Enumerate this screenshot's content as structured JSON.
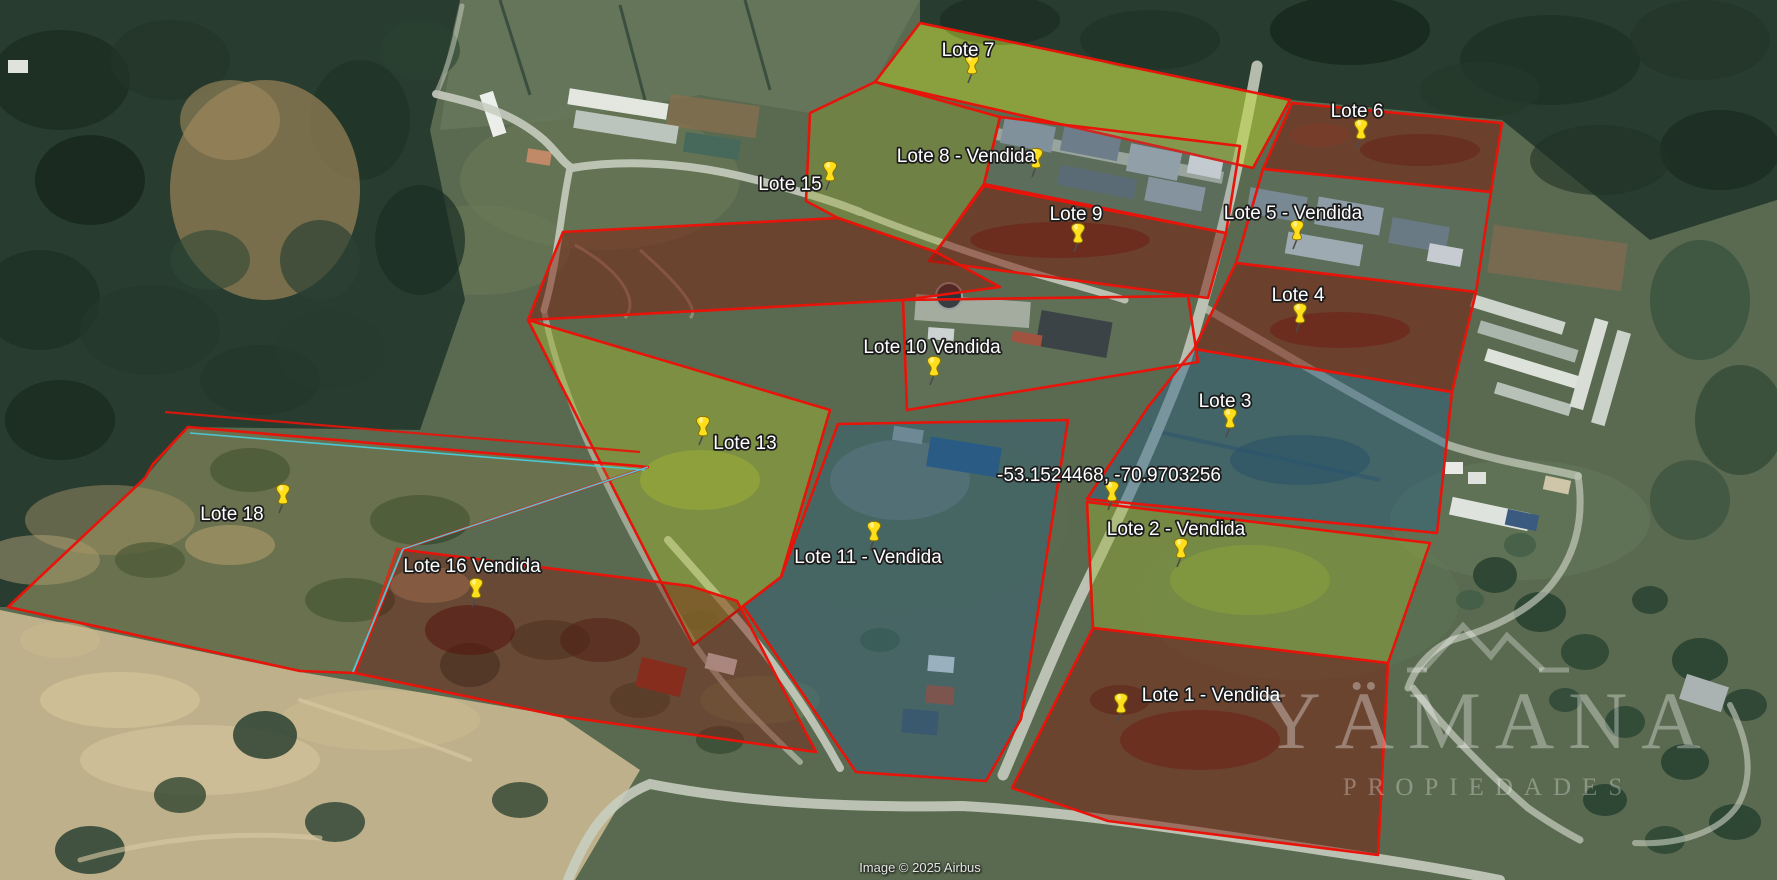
{
  "map": {
    "attribution": "Image © 2025 Airbus",
    "watermark": {
      "brand": "YÄMANA",
      "tagline": "PROPIEDADES"
    },
    "colors": {
      "boundary": "#e81309",
      "boundary_alt": "#49cfe0",
      "pin": "#ffdf1c",
      "pin_stroke": "#8a7500",
      "label": "#ffffff"
    },
    "coordinate_marker": {
      "label": "-53.1524468, -70.9703256",
      "label_x": 1109,
      "label_y": 481,
      "pin_x": 1112,
      "pin_y": 494
    },
    "lots": [
      {
        "id": "lote7",
        "label": "Lote 7",
        "status": "disponible",
        "label_x": 968,
        "label_y": 56,
        "pin_x": 972,
        "pin_y": 67,
        "fill": "#b9d32c",
        "fill_opacity": 0.5,
        "points": "920,23 1290,100 1253,168 875,82"
      },
      {
        "id": "lote15",
        "label": "Lote 15",
        "status": "disponible",
        "label_x": 790,
        "label_y": 190,
        "pin_x": 830,
        "pin_y": 174,
        "fill": "#97a834",
        "fill_opacity": 0.38,
        "points": "810,113 875,82 1000,117 984,184 936,252 838,218 806,201"
      },
      {
        "id": "lote8",
        "label": "Lote 8 - Vendida",
        "status": "vendida",
        "label_x": 966,
        "label_y": 162,
        "pin_x": 1036,
        "pin_y": 161,
        "fill": "#6b8093",
        "fill_opacity": 0.18,
        "points": "1000,117 1240,146 1226,233 984,184"
      },
      {
        "id": "lote9",
        "label": "Lote 9",
        "status": "disponible",
        "label_x": 1076,
        "label_y": 220,
        "pin_x": 1078,
        "pin_y": 236,
        "fill": "#7b1d10",
        "fill_opacity": 0.52,
        "points": "984,186 1226,233 1208,298 929,261"
      },
      {
        "id": "lote6",
        "label": "Lote 6",
        "status": "disponible",
        "label_x": 1357,
        "label_y": 117,
        "pin_x": 1361,
        "pin_y": 132,
        "fill": "#7b1d10",
        "fill_opacity": 0.52,
        "points": "1292,103 1502,123 1491,192 1263,169"
      },
      {
        "id": "lote5",
        "label": "Lote 5 - Vendida",
        "status": "vendida",
        "label_x": 1293,
        "label_y": 219,
        "pin_x": 1297,
        "pin_y": 233,
        "fill": "#6b8093",
        "fill_opacity": 0.15,
        "points": "1263,169 1491,192 1476,292 1236,263"
      },
      {
        "id": "lote4",
        "label": "Lote 4",
        "status": "disponible",
        "label_x": 1298,
        "label_y": 301,
        "pin_x": 1300,
        "pin_y": 316,
        "fill": "#7b1d10",
        "fill_opacity": 0.52,
        "points": "1236,263 1476,292 1452,392 1194,349"
      },
      {
        "id": "lote3",
        "label": "Lote 3",
        "status": "disponible",
        "label_x": 1225,
        "label_y": 407,
        "pin_x": 1230,
        "pin_y": 421,
        "fill": "#275f86",
        "fill_opacity": 0.45,
        "points": "1194,349 1452,392 1437,533 1087,499 1148,407"
      },
      {
        "id": "lote10",
        "label": "Lote 10 Vendida",
        "status": "vendida",
        "label_x": 932,
        "label_y": 353,
        "pin_x": 934,
        "pin_y": 369,
        "fill": "#9aa5a0",
        "fill_opacity": 0.1,
        "points": "903,300 1188,296 1198,362 907,410"
      },
      {
        "id": "lote13",
        "label": "Lote 13",
        "status": "disponible",
        "label_x": 745,
        "label_y": 449,
        "pin_x": 703,
        "pin_y": 429,
        "fill": "#a9bd34",
        "fill_opacity": 0.45,
        "points": "528,320 830,410 781,577 693,645"
      },
      {
        "id": "lote11",
        "label": "Lote 11 - Vendida",
        "status": "vendida",
        "label_x": 868,
        "label_y": 563,
        "pin_x": 874,
        "pin_y": 534,
        "fill": "#275f86",
        "fill_opacity": 0.38,
        "points": "838,424 1068,420 1021,719 986,781 856,772 743,606 781,577"
      },
      {
        "id": "lote2",
        "label": "Lote 2 - Vendida",
        "status": "vendida",
        "label_x": 1176,
        "label_y": 535,
        "pin_x": 1181,
        "pin_y": 551,
        "fill": "#9cb335",
        "fill_opacity": 0.42,
        "points": "1087,502 1430,543 1388,663 1093,628"
      },
      {
        "id": "lote1",
        "label": "Lote 1 - Vendida",
        "status": "vendida",
        "label_x": 1211,
        "label_y": 701,
        "pin_x": 1121,
        "pin_y": 706,
        "fill": "#7b1d10",
        "fill_opacity": 0.5,
        "points": "1093,628 1388,663 1378,855 1108,821 1012,788"
      },
      {
        "id": "lote16",
        "label": "Lote 16 Vendida",
        "status": "vendida",
        "label_x": 472,
        "label_y": 572,
        "pin_x": 476,
        "pin_y": 591,
        "fill": "#7b1d10",
        "fill_opacity": 0.42,
        "points": "397,549 690,586 737,601 816,752 560,716 355,673"
      },
      {
        "id": "lote18",
        "label": "Lote 18",
        "status": "disponible",
        "label_x": 232,
        "label_y": 520,
        "pin_x": 283,
        "pin_y": 497,
        "fill": "#9f8f4d",
        "fill_opacity": 0.22,
        "points": "188,427 648,467 403,549 355,673 300,671 8,607 145,478 153,464"
      },
      {
        "id": "unlabeled-lot",
        "label": "",
        "status": "",
        "label_x": null,
        "label_y": null,
        "pin_x": null,
        "pin_y": null,
        "fill": "#7b1d10",
        "fill_opacity": 0.5,
        "points": "563,232 838,218 936,252 1000,287 903,300 528,320"
      }
    ]
  }
}
